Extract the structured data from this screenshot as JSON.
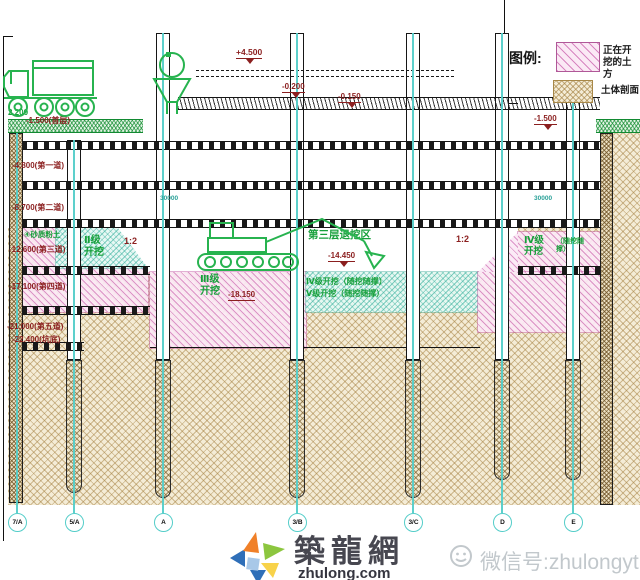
{
  "legend": {
    "title": "图例:",
    "excavating": "正在开挖的土方",
    "soil_section": "土体剖面"
  },
  "elevations": {
    "platform_top": "+4.500",
    "slab_a": "-0.200",
    "slab_b": "-0.150",
    "ground_left": "-1.500(首层)",
    "ground_right": "-1.500",
    "strut_1": "-4.800(第一道)",
    "strut_2": "-8.700(第二道)",
    "strut_3": "-12.600(第三道)",
    "strut_4": "-17.100(第四道)",
    "strut_5": "-21.000(第五道)",
    "pit_bottom": "-22.400(坑底)",
    "mid_level": "-14.450",
    "dig_level": "-18.150"
  },
  "slopes": {
    "left": "1:2",
    "right": "1:2"
  },
  "zones": {
    "soil_layer": "④砂质粉土",
    "level_2": "Ⅱ级开挖",
    "level_3": "Ⅲ级开挖",
    "third_area": "第三层退挖区",
    "level_4": "Ⅳ级开挖（随挖随撑）",
    "level_5": "Ⅴ级开挖（随挖随撑）",
    "level_4_right": "Ⅳ级开挖",
    "level_4_right_note": "（随挖随撑）"
  },
  "dimensions": {
    "top_left": "2.200",
    "span_left": "30000",
    "span_right": "30000"
  },
  "axes": [
    "7/A",
    "5/A",
    "A",
    "3/B",
    "3/C",
    "D",
    "E"
  ],
  "watermark": {
    "site_name": "築龍網",
    "site_domain": "zhulong.com",
    "wechat": "微信号:zhulongyt"
  },
  "colors": {
    "label_red": "#8b1f1f",
    "equipment_green": "#27b34f",
    "axis_teal": "#54cdc9",
    "hatch_pink": "#c85aaa",
    "hatch_tan": "#a48040",
    "grass_green": "#148c32"
  }
}
